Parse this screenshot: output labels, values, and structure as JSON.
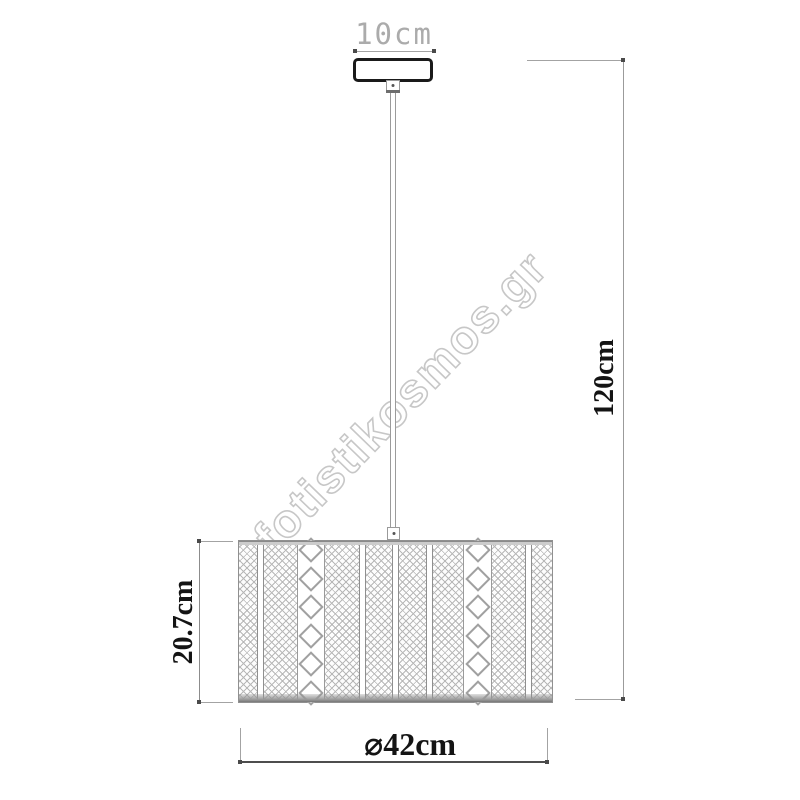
{
  "watermark": "fotistikosmos.gr",
  "dimensions": {
    "canopy_width": "10cm",
    "total_drop_height": "120cm",
    "shade_height": "20.7cm",
    "shade_diameter": "⌀42cm"
  },
  "colors": {
    "background": "#ffffff",
    "dimension_text": "#141414",
    "canopy_width_text": "#ababab",
    "line_gray": "#a3a3a3",
    "terminator_dark": "#4a4a4a",
    "pattern_gray": "#b8b8b8",
    "watermark_gray": "#c7c7c7",
    "canopy_outline": "#1a1a1a"
  }
}
